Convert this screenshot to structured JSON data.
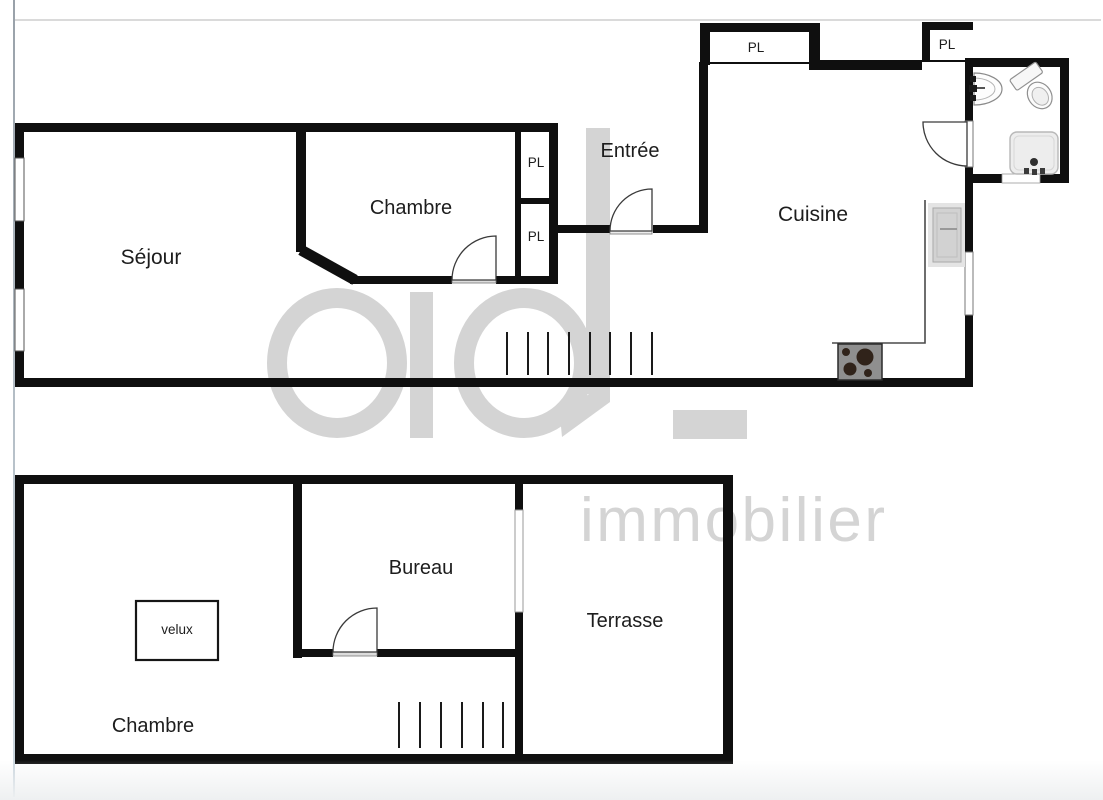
{
  "watermark": {
    "logo": "ad_",
    "brand": "immobilier",
    "color": "#d4d4d4"
  },
  "upper_floor": {
    "sejour": "Séjour",
    "chambre": "Chambre",
    "entree": "Entrée",
    "cuisine": "Cuisine",
    "closets": [
      "PL",
      "PL",
      "PL",
      "PL"
    ]
  },
  "lower_floor": {
    "chambre": "Chambre",
    "bureau": "Bureau",
    "terrasse": "Terrasse",
    "skylight": "velux"
  },
  "colors": {
    "wall": "#0f0f0f",
    "watermark": "#d4d4d4",
    "label": "#1d1d1d",
    "threshold": "#dcdcdc"
  }
}
